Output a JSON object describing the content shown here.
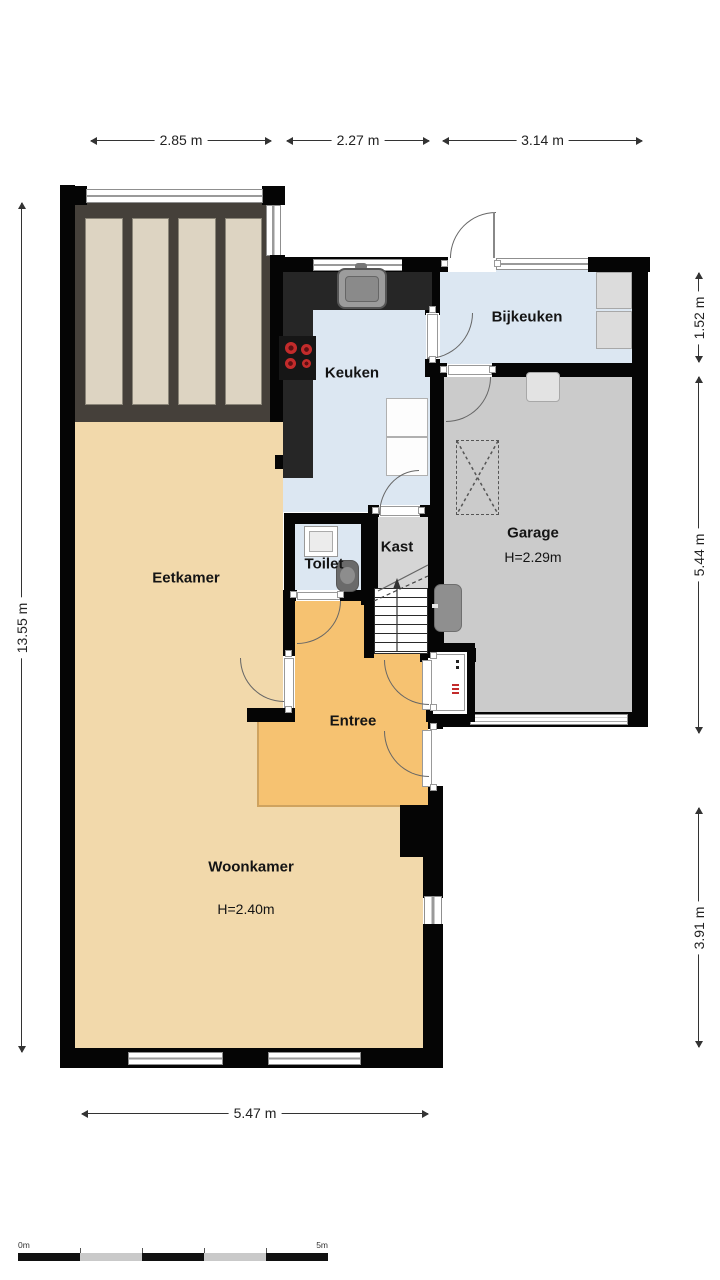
{
  "floorplan": {
    "rooms": {
      "eetkamer": {
        "label": "Eetkamer"
      },
      "woonkamer": {
        "label": "Woonkamer",
        "ceiling_height": "H=2.40m"
      },
      "keuken": {
        "label": "Keuken"
      },
      "bijkeuken": {
        "label": "Bijkeuken"
      },
      "garage": {
        "label": "Garage",
        "ceiling_height": "H=2.29m"
      },
      "kast": {
        "label": "Kast"
      },
      "toilet": {
        "label": "Toilet"
      },
      "entree": {
        "label": "Entree"
      }
    },
    "dimensions": {
      "top": [
        {
          "label": "2.85 m"
        },
        {
          "label": "2.27 m"
        },
        {
          "label": "3.14 m"
        }
      ],
      "left": {
        "label": "13.55 m"
      },
      "right": [
        {
          "label": "1.52 m"
        },
        {
          "label": "5.44 m"
        },
        {
          "label": "3.91 m"
        }
      ],
      "bottom": {
        "label": "5.47 m"
      }
    },
    "scale_bar": {
      "start": "0m",
      "end": "5m"
    },
    "colors": {
      "wall": "#050505",
      "living_floor": "#f2d9ab",
      "entree_floor": "#f6c271",
      "wet_floor": "#dce7f2",
      "garage_floor": "#cbcbcb",
      "kast_floor": "#d6d6d6",
      "counter": "#262626",
      "veranda_panel": "#ddd4c2",
      "burner_red": "#c32b2b"
    }
  }
}
